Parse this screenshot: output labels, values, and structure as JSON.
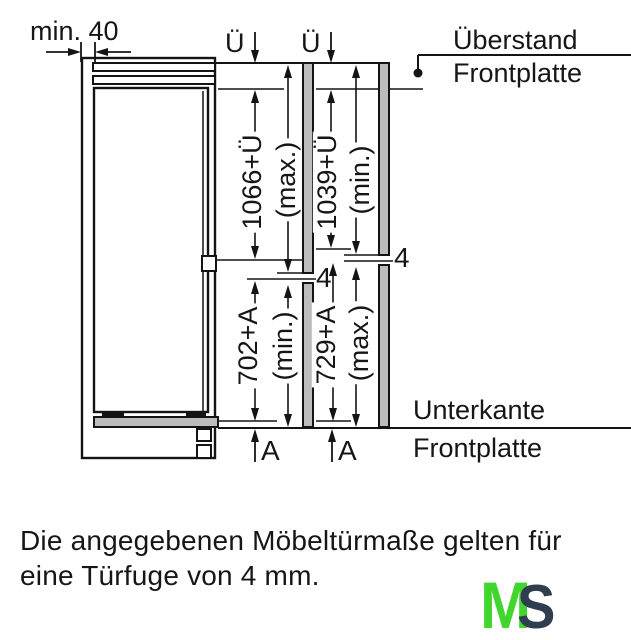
{
  "dimensions": {
    "min_gap": "min. 40",
    "overhang_symbol": "Ü",
    "upper_left": {
      "value": "1066+Ü",
      "qualifier": "(max.)"
    },
    "upper_right": {
      "value": "1039+Ü",
      "qualifier": "(min.)"
    },
    "lower_left": {
      "value": "702+A",
      "qualifier": "(min.)"
    },
    "lower_right": {
      "value": "729+A",
      "qualifier": "(max.)"
    },
    "door_gap": "4",
    "bottom_gap_symbol": "A"
  },
  "labels": {
    "overhang_line1": "Überstand",
    "overhang_line2": "Frontplatte",
    "bottom_edge_line1": "Unterkante",
    "bottom_edge_line2": "Frontplatte"
  },
  "note": {
    "line1": "Die angegebenen Möbeltürmaße gelten für",
    "line2": "eine Türfuge von 4 mm."
  },
  "logo": {
    "letter_m": "M",
    "letter_s": "S",
    "m_color": "#41d62e",
    "s_color": "#2e3d4f"
  },
  "colors": {
    "panel_gray": "#bcbcbc",
    "line": "#141414"
  }
}
